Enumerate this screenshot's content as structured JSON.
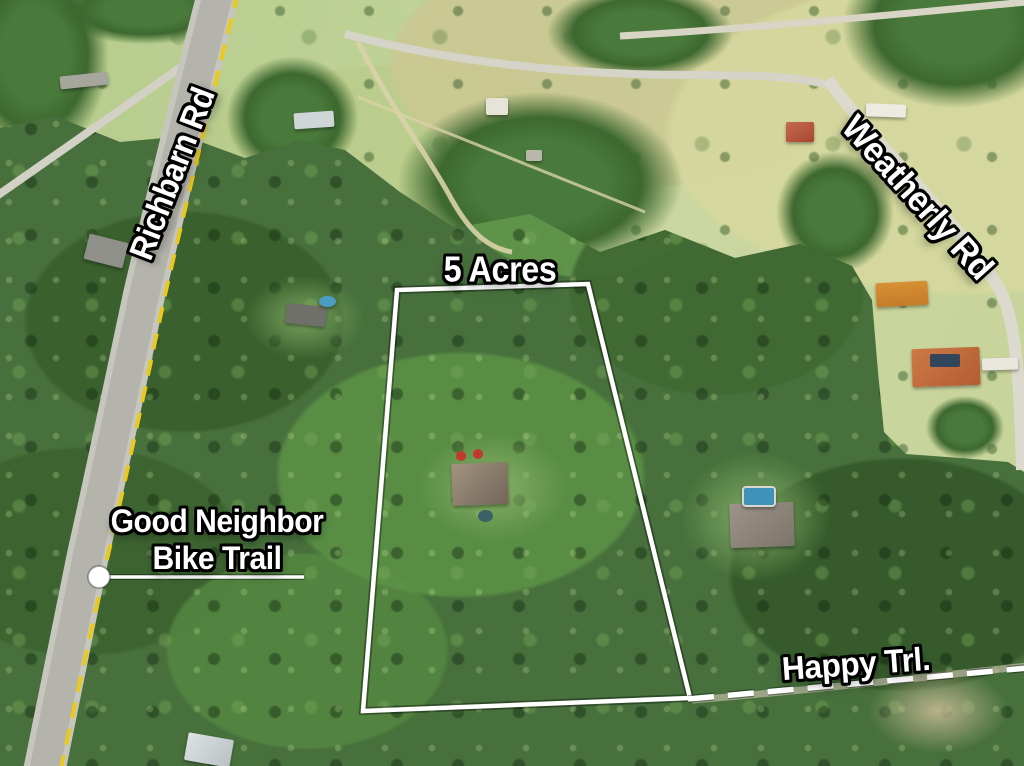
{
  "scene": {
    "type": "aerial drone photograph",
    "subject": "wooded 5-acre residential parcel outlined in white, bordered by roads and a bike trail"
  },
  "annotations": {
    "parcel_acreage": "5 Acres",
    "road_left": "Richbarn Rd",
    "road_right": "Weatherly Rd",
    "road_bottom_right": "Happy Trl.",
    "bike_trail_line1": "Good Neighbor",
    "bike_trail_line2": "Bike Trail"
  },
  "colors": {
    "parcel_outline": "#ffffff",
    "bike_trail_dash": "#eac91f",
    "happy_trail_dash": "#ffffff",
    "label_fill": "#ffffff",
    "label_outline": "#000000"
  }
}
